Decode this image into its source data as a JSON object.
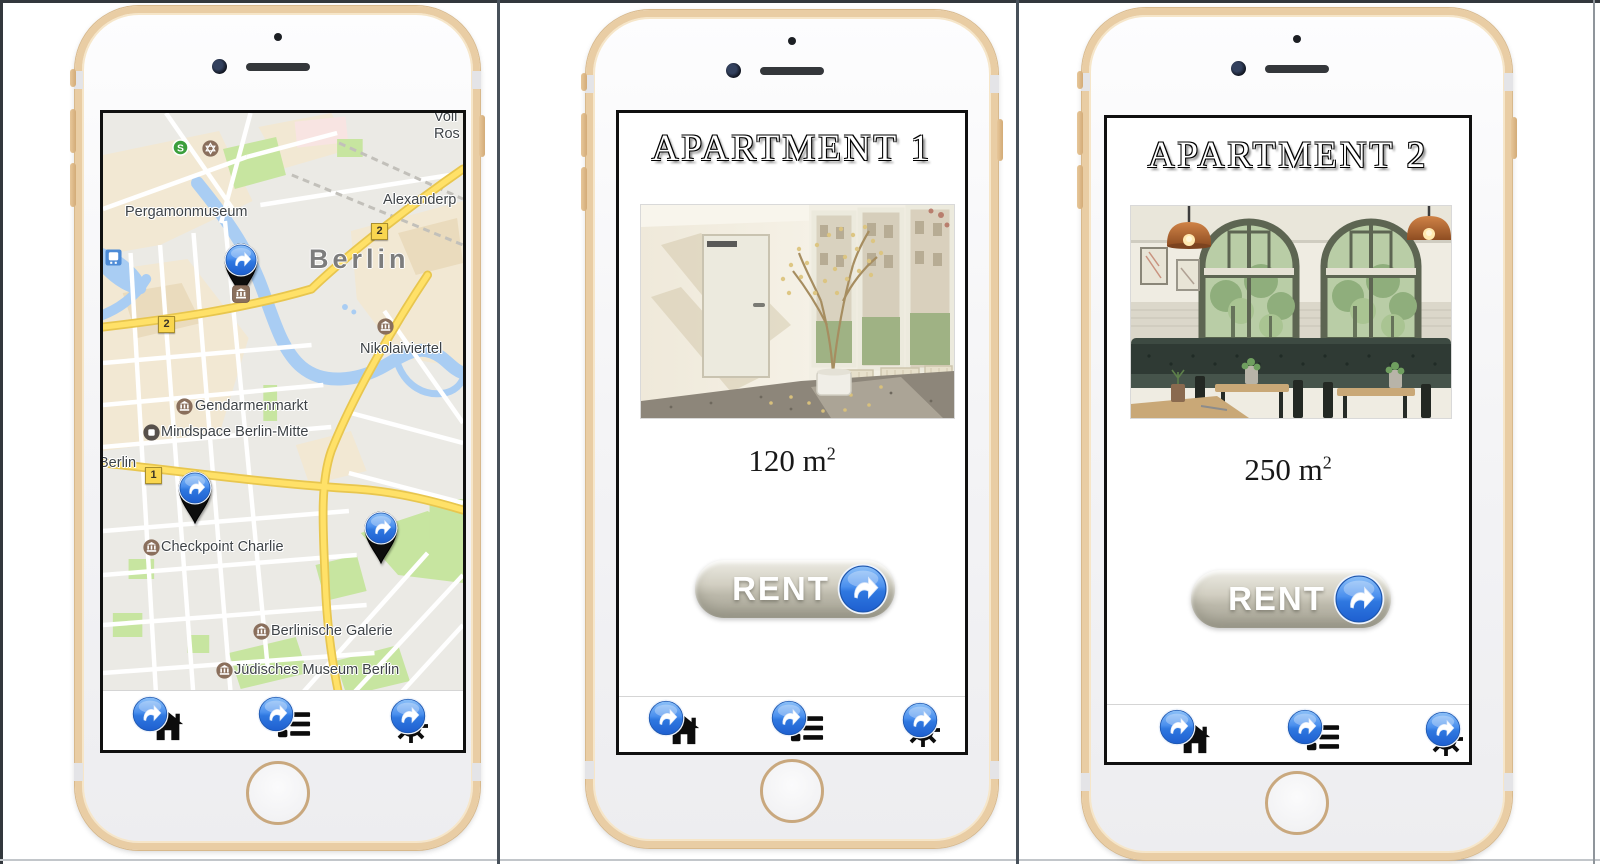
{
  "window": {
    "background": "#ffffff"
  },
  "map_phone": {
    "city_label_large": "Berlin",
    "city_label_small": "Berlin",
    "place_labels": {
      "voll": "Voll",
      "ros": "Ros",
      "alexanderplatz": "Alexanderp",
      "pergamonmuseum": "Pergamonmuseum",
      "nikolaiviertel": "Nikolaiviertel",
      "gendarmenmarkt": "Gendarmenmarkt",
      "mindspace": "Mindspace Berlin-Mitte",
      "checkpoint_charlie": "Checkpoint Charlie",
      "berlinische_galerie": "Berlinische Galerie",
      "juedisches_museum": "Jüdisches Museum Berlin"
    },
    "route_badges": {
      "upper_2": "2",
      "left_2": "2",
      "lower_1": "1"
    },
    "sbahn": "S"
  },
  "apartments": [
    {
      "title": "APARTMENT 1",
      "area_value": "120 m",
      "area_exponent": "2",
      "rent_label": "RENT"
    },
    {
      "title": "APARTMENT 2",
      "area_value": "250 m",
      "area_exponent": "2",
      "rent_label": "RENT"
    }
  ],
  "nav_icons": [
    "home",
    "list",
    "settings"
  ],
  "icons": {
    "hotspot": "link-arrow-hotspot",
    "map_pin": "location-pin",
    "poi_museum": "museum",
    "poi_sbahn": "s-bahn-station",
    "poi_synagogue": "synagogue",
    "poi_tram": "tram-stop",
    "poi_business": "business"
  },
  "colors": {
    "phone_frame_gold": "#e9cda4",
    "hotspot_blue": "#3c82e8",
    "pin_black": "#0d0d0d",
    "road_yellow": "#ffe168",
    "water_blue": "#a9cdf3",
    "park_green": "#c7e5a0",
    "rent_button_beige": "#c9c6ba",
    "rent_text": "#ffffff"
  }
}
